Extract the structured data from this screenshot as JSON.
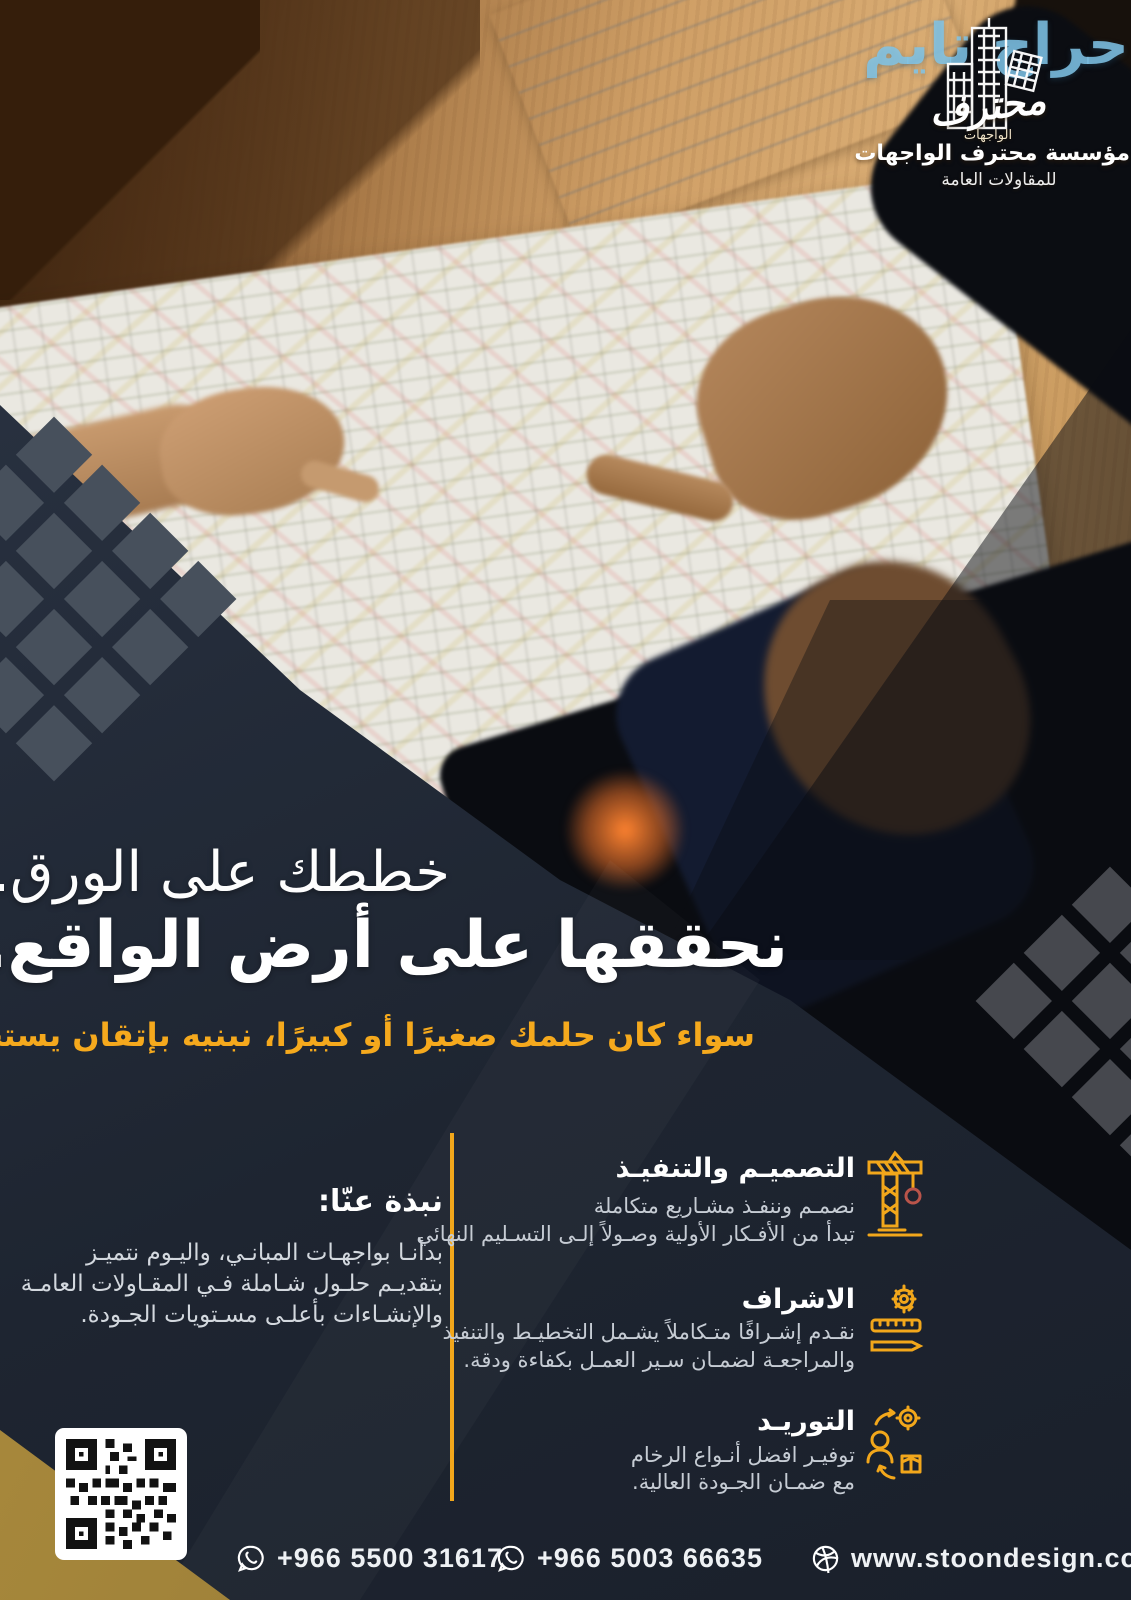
{
  "watermark": {
    "text": "حراج تايم"
  },
  "logo": {
    "mark_title": "محترف",
    "mark_sub": "الواجهات",
    "brand": "مؤسسة محترف الواجهات",
    "tagline": "للمقاولات العامة"
  },
  "headline": {
    "line1": "خططك على الورق...",
    "line2": "نحققها على أرض الواقع.",
    "subtitle": "سواء كان حلمك صغيرًا أو كبيرًا، نبنيه بإتقان يستحقه."
  },
  "about": {
    "title": "نبذة عنّا:",
    "lines": [
      "بدأنـا بواجهـات المبانـي، واليـوم نتميـز",
      "بتقديـم حلـول شـاملة فـي المقـاولات العامـة",
      "والإنشـاءات بأعلـى مسـتويات الجـودة."
    ]
  },
  "services": [
    {
      "title": "التصميـم والتنفيـذ",
      "icon": "crane-icon",
      "lines": [
        "نصمـم وننفـذ مشـاريع متكاملة",
        "تبدأ من الأفـكار الأولية وصـولاً إلـى التسـليم النهائي"
      ]
    },
    {
      "title": "الاشراف",
      "icon": "supervision-icon",
      "lines": [
        "نقـدم إشـرافًا متـكاملاً يشـمل التخطيـط والتنفيذ",
        "والمراجعـة لضمـان سـير العمـل بكفاءة ودقة."
      ]
    },
    {
      "title": "التوريـد",
      "icon": "supply-icon",
      "lines": [
        "توفيـر افضل أنـواع الرخام",
        "مع ضمـان الجـودة العالية."
      ]
    }
  ],
  "social": {
    "pinterest": "p",
    "facebook": "f"
  },
  "contact": {
    "phone1": "+966 5500 31617",
    "phone2": "+966 5003 66635",
    "website": "www.stoondesign.com"
  },
  "colors": {
    "accent": "#F2A71B",
    "navy": "#222A37",
    "gold": "#A8893F",
    "watermark_blue": "#80C4E8"
  }
}
